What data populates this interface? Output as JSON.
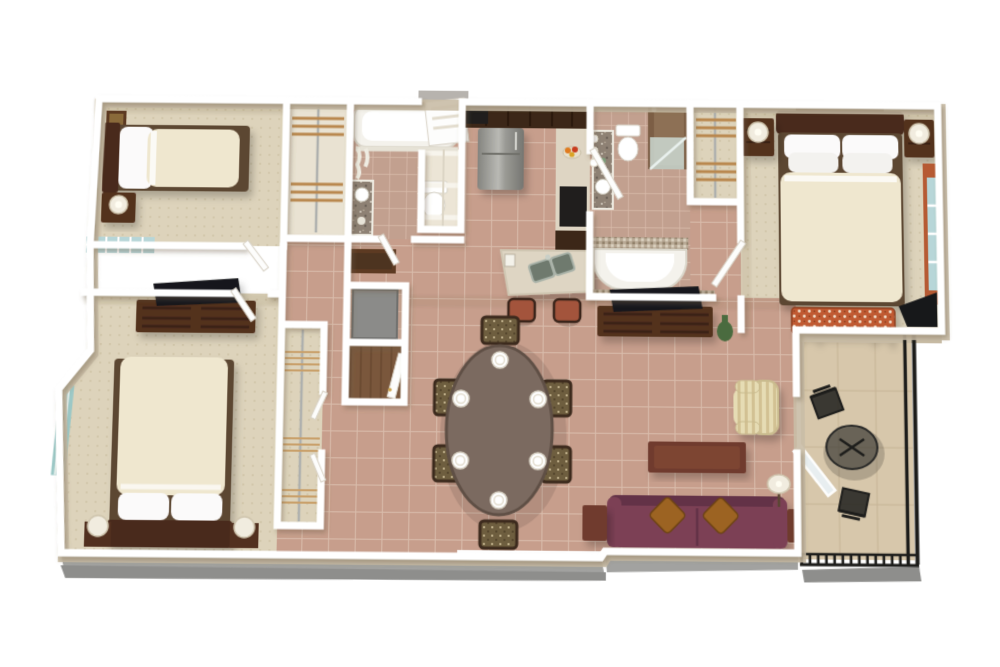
{
  "scene": {
    "title": "3D apartment floor plan rendering",
    "description": "Bird's-eye 3D cutaway render of a two-bedroom-plus-den apartment with kitchen, two bathrooms, dining area, living room and balcony on a white background",
    "visible_text": ""
  },
  "palette": {
    "background": "#ffffff",
    "wall_cap": "#ffffff",
    "wall_face": "#c9bca6",
    "slab": "#a2a2a0",
    "slab_dark": "#8e8e8c",
    "carpet": "#ddd3bb",
    "carpet_dot": "#cdc1a4",
    "tile": "#c79e8c",
    "tile_grout": "#d9bcab",
    "bath_tile": "#c2a08f",
    "balcony_floor": "#d7c7ab",
    "railing": "#1d1d1b",
    "duvet": "#efe7cf",
    "pillow": "#fbfafa",
    "bed_base": "#5c4632",
    "headboard": "#4a2c1c",
    "wood_dark": "#52301f",
    "wood_mid": "#6b4a33",
    "wood_red": "#6f3b2d",
    "sofa": "#7b4155",
    "sofa_dark": "#643246",
    "sofa_pillow": "#9c6320",
    "bench_fabric": "#c05a32",
    "armchair": "#e6dcb4",
    "armchair_stripe": "#d2c193",
    "dining_table": "#7b6a60",
    "chair_seat": "#6e5e3f",
    "chair_wood": "#3c2a1d",
    "stool_seat": "#a3543c",
    "counter": "#ded5c3",
    "cabinet": "#3c2718",
    "steel": "#9b9b97",
    "steel_dark": "#7e7e7a",
    "oven": "#201e1d",
    "sink_metal": "#6f7a6e",
    "granite": "#8e8174",
    "shower_tile": "#7c5e45",
    "shower_glass": "#cfe0da",
    "window_glass": "#b7d6d8",
    "curtain_master": "#b65a33",
    "curtain_guest": "#9cc8c6",
    "closet_shelf": "#b9884f",
    "wire_shelf": "#c9a06a",
    "vase_green": "#4a6b3f",
    "lamp_shade": "#f1ecdf",
    "tv_black": "#17181a",
    "art_frame": "#5d3a22",
    "art_canvas": "#8a6a3a",
    "wood_floor": "#7a573c",
    "appliance_gray": "#8b8b89",
    "tub_white": "#f4f2ec",
    "outside_gray": "#b7b3ae"
  },
  "rooms": [
    {
      "id": "bedroom-1",
      "name": "guest bedroom (top left)",
      "floor": "carpet",
      "furniture": [
        "twin bed with cream duvet",
        "white pillows",
        "dark wood nightstand",
        "ball lamp",
        "wall art",
        "corner window"
      ]
    },
    {
      "id": "closet-1",
      "name": "reach-in closet",
      "floor": "cream",
      "furniture": [
        "slatted wood shelves",
        "closet rod"
      ]
    },
    {
      "id": "bathroom-2",
      "name": "hall bathroom",
      "floor": "tile",
      "furniture": [
        "bathtub with shower curtain",
        "toilet",
        "granite vanity with sink"
      ]
    },
    {
      "id": "entry",
      "name": "entry",
      "floor": "tile",
      "furniture": [
        "white front door",
        "coat closet with double doors"
      ]
    },
    {
      "id": "kitchen",
      "name": "kitchen",
      "floor": "tile",
      "furniture": [
        "stainless refrigerator",
        "dark walnut cabinets",
        "wall oven",
        "counter with fruit bowl",
        "angled island with double sink",
        "two rust bar stools"
      ]
    },
    {
      "id": "master-bathroom",
      "name": "master bathroom",
      "floor": "tile",
      "furniture": [
        "vanity with vessel sink and bulb lights",
        "toilet",
        "walk-in tiled shower with glass door",
        "garden tub with mosaic deck"
      ]
    },
    {
      "id": "master-closet",
      "name": "master walk-in closet",
      "floor": "carpet",
      "furniture": [
        "wood shelving",
        "hanging rod"
      ]
    },
    {
      "id": "master-bedroom",
      "name": "master bedroom (top right)",
      "floor": "carpet",
      "furniture": [
        "king bed with four pillows",
        "dark wood headboard",
        "two nightstands with lamps",
        "panoramic wall art",
        "patterned upholstered bench",
        "window with rust curtains",
        "corner tv"
      ]
    },
    {
      "id": "bedroom-2",
      "name": "guest bedroom (bottom left)",
      "floor": "carpet",
      "furniture": [
        "dresser with flat screen tv",
        "queen bed with cream duvet",
        "two ball lamps on side tables",
        "window with aqua curtains"
      ]
    },
    {
      "id": "closet-2",
      "name": "wire-shelf closet",
      "floor": "carpet",
      "furniture": [
        "wire shelves",
        "closet rod",
        "louvered doors"
      ]
    },
    {
      "id": "hallway",
      "name": "hallway",
      "floor": "tile",
      "furniture": [
        "framed artwork",
        "utility closet with water heater",
        "storage closet with wood floor and door"
      ]
    },
    {
      "id": "dining-area",
      "name": "dining area",
      "floor": "tile",
      "furniture": [
        "oval dark wood table",
        "six upholstered chairs",
        "six white place settings"
      ]
    },
    {
      "id": "living-room",
      "name": "living room",
      "floor": "tile",
      "furniture": [
        "media console with flat tv",
        "green bottle vase",
        "plum sofa with two amber pillows",
        "two dark end tables",
        "coffee table",
        "floor lamp with white shade",
        "striped wingback armchair"
      ]
    },
    {
      "id": "balcony",
      "name": "balcony",
      "floor": "concrete",
      "furniture": [
        "black wrought-iron railing",
        "round glass bistro table",
        "two black metal chairs",
        "open glass door"
      ]
    }
  ]
}
